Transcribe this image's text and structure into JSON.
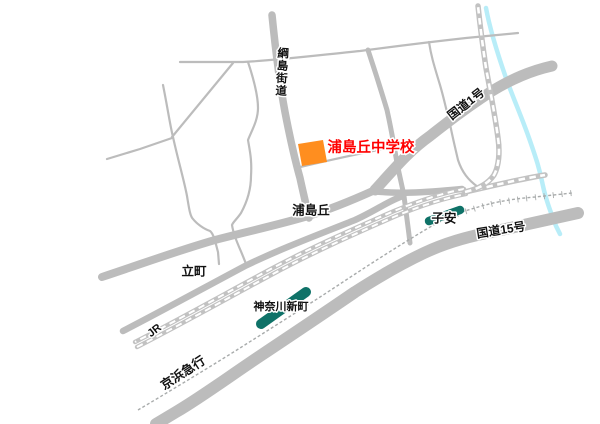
{
  "map": {
    "destination": {
      "name": "浦島丘中学校",
      "label_color": "#ff0000",
      "marker_color": "#ff8e1f"
    },
    "roads": {
      "tsunashima_kaido": "綱島街道",
      "route_1": "国道1号",
      "urashimaoka": "浦島丘",
      "tachimachi": "立町",
      "route_15": "国道15号"
    },
    "railways": {
      "jr": "JR",
      "keikyu": "京浜急行"
    },
    "stations": {
      "koyasu": "子安",
      "kanagawa_shinmachi": "神奈川新町"
    },
    "colors": {
      "road": "#bcbcbc",
      "rail": "#c2c2c2",
      "keikyu_line": "#a8abab",
      "river": "#b8edf8",
      "station": "#0f7268",
      "label": "#111111"
    }
  }
}
